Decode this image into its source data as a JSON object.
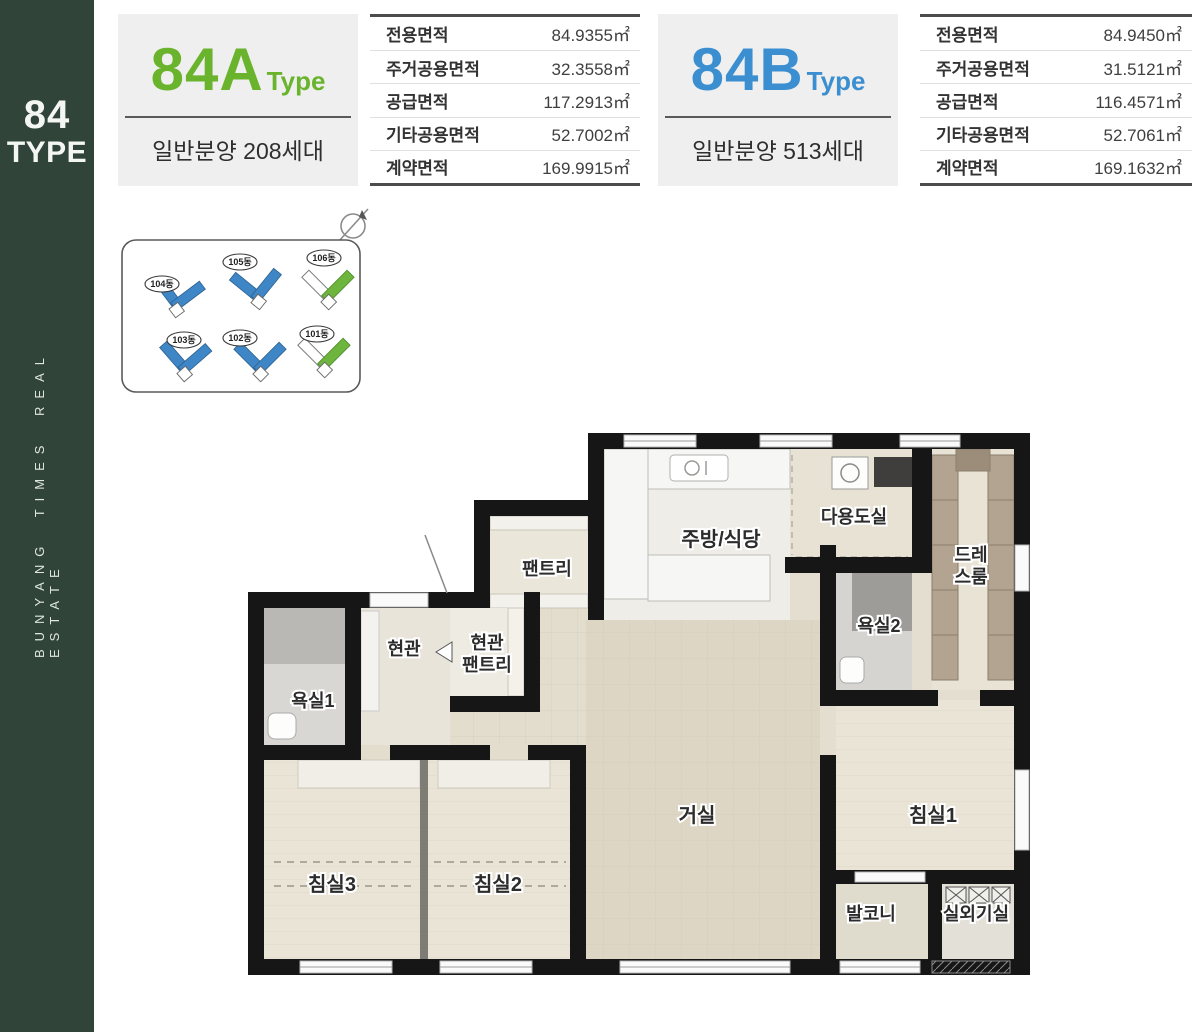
{
  "sidebar": {
    "title_line1": "84",
    "title_line2": "TYPE",
    "vertical_text": "BUNYANG TIMES REAL ESTATE",
    "bg_color": "#30443a"
  },
  "type_a": {
    "name": "84A",
    "suffix": "Type",
    "accent_color": "#6ab32d",
    "subtitle": "일반분양 208세대",
    "table": {
      "rows": [
        {
          "label": "전용면적",
          "value": "84.9355㎡"
        },
        {
          "label": "주거공용면적",
          "value": "32.3558㎡"
        },
        {
          "label": "공급면적",
          "value": "117.2913㎡"
        },
        {
          "label": "기타공용면적",
          "value": "52.7002㎡"
        },
        {
          "label": "계약면적",
          "value": "169.9915㎡"
        }
      ]
    }
  },
  "type_b": {
    "name": "84B",
    "suffix": "Type",
    "accent_color": "#3b8fd0",
    "subtitle": "일반분양 513세대",
    "table": {
      "rows": [
        {
          "label": "전용면적",
          "value": "84.9450㎡"
        },
        {
          "label": "주거공용면적",
          "value": "31.5121㎡"
        },
        {
          "label": "공급면적",
          "value": "116.4571㎡"
        },
        {
          "label": "기타공용면적",
          "value": "52.7061㎡"
        },
        {
          "label": "계약면적",
          "value": "169.1632㎡"
        }
      ]
    }
  },
  "site_map": {
    "building_color_blue": "#3e86c5",
    "building_color_green": "#6db53c",
    "buildings": [
      {
        "label": "104동"
      },
      {
        "label": "105동"
      },
      {
        "label": "106동"
      },
      {
        "label": "103동"
      },
      {
        "label": "102동"
      },
      {
        "label": "101동"
      }
    ]
  },
  "floor_plan": {
    "labels": {
      "pantry": "팬트리",
      "kitchen_dining": "주방/식당",
      "utility": "다용도실",
      "dress_room_line1": "드레",
      "dress_room_line2": "스룸",
      "bath2": "욕실2",
      "entrance": "현관",
      "entrance_pantry_line1": "현관",
      "entrance_pantry_line2": "팬트리",
      "bath1": "욕실1",
      "living": "거실",
      "bed1": "침실1",
      "bed2": "침실2",
      "bed3": "침실3",
      "balcony": "발코니",
      "outdoor_unit": "실외기실"
    }
  }
}
